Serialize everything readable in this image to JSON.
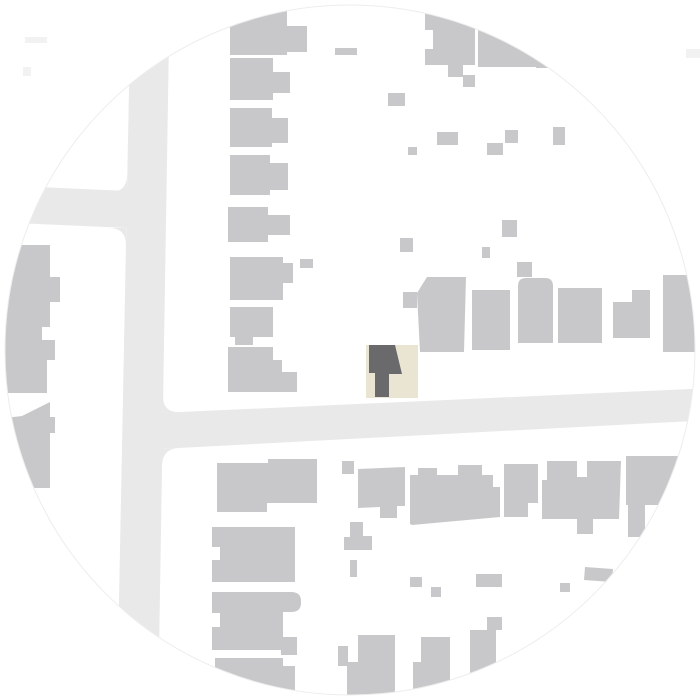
{
  "title": "Circular site location plan",
  "map": {
    "type": "site-plan",
    "canvas": {
      "width": 700,
      "height": 700
    },
    "background": "#ffffff",
    "circle": {
      "cx": 350,
      "cy": 350,
      "r": 345,
      "outline_color": "#ededee",
      "outline_width": 1
    },
    "colors": {
      "road": "#e9e9ea",
      "building": "#c8c8ca",
      "site_parcel": "#eae5d3",
      "site_building": "#6a6a6c",
      "faded_fragment": "#f2f2f2"
    },
    "roads": [
      {
        "name": "vertical-street",
        "path": "M130,38 L169,38 L159,652 L118,652 Z"
      },
      {
        "name": "west-side-street",
        "path": "M-8,185 L128,191 L128,228 L-8,222 Z"
      },
      {
        "name": "main-cross-street",
        "path": "M159,413 L712,388 L712,420 L159,449 Z"
      }
    ],
    "road_fillets": [
      "M127,175 L127,192 L110,192 Q127,192 127,175 Z",
      "M126,245 L126,228 L109,228 Q126,228 126,245 Z",
      "M163,396 L163,413 L180,412 Q163,413 163,396 Z",
      "M162,466 L162,449 L179,448 Q162,449 162,466 Z"
    ],
    "buildings": [
      "M230,0 L287,0 L287,26 L307,26 L307,52 L287,52 L287,55 L230,55 Z",
      "M230,58 L273,58 L273,72 L290,72 L290,93 L273,93 L273,100 L230,100 Z",
      "M230,108 L272,108 L272,118 L288,118 L288,143 L272,143 L272,147 L230,147 Z",
      "M230,155 L270,155 L270,163 L288,163 L288,190 L270,190 L270,195 L230,195 Z",
      "M228,207 L268,207 L268,215 L290,215 L290,235 L268,235 L268,242 L228,242 Z",
      "M230,257 L283,257 L283,263 L293,263 L293,283 L283,283 L283,300 L230,300 Z",
      "M300,259 L313,259 L313,268 L300,268 Z",
      "M230,307 L273,307 L273,337 L253,337 L253,345 L235,345 L235,337 L230,337 Z",
      "M228,347 L273,347 L273,360 L282,360 L282,372 L297,372 L297,392 L228,392 Z",
      "M-12,245 L50,245 L50,277 L60,277 L60,302 L50,302 L50,327 L42,327 L42,340 L55,340 L55,360 L47,360 L47,393 L-12,393 Z",
      "M-12,420 L22,416 L50,402 L50,417 L55,417 L55,433 L50,433 L50,488 L-12,488 Z",
      "M425,0 L475,0 L475,65 L463,65 L463,77 L448,77 L448,65 L425,65 L425,49 L433,49 L433,30 L425,30 Z",
      "M463,75 L475,75 L475,87 L463,87 Z",
      "M478,8 L543,8 L543,67 L478,67 Z",
      "M536,52 L560,52 L560,68 L536,68 Z",
      "M335,48 L357,48 L357,55 L335,55 Z",
      "M388,93 L405,93 L405,106 L388,106 Z",
      "M437,132 L458,132 L458,145 L437,145 Z",
      "M505,130 L518,130 L518,143 L505,143 Z",
      "M553,127 L565,127 L565,145 L553,145 Z",
      "M487,143 L503,143 L503,155 L487,155 Z",
      "M408,147 L417,147 L417,155 L408,155 Z",
      "M400,238 L413,238 L413,252 L400,252 Z",
      "M502,220 L517,220 L517,237 L502,237 Z",
      "M482,247 L490,247 L490,258 L482,258 Z",
      "M517,262 L532,262 L532,277 L517,277 Z",
      "M403,292 L417,292 L417,308 L403,308 Z",
      "M427,277 L466,277 L464,352 L420,352 L417,293 Z",
      "M472,290 L510,290 L510,350 L472,350 Z",
      "M518,286 Q518,278 526,278 L545,278 Q553,278 553,286 L553,343 L518,343 Z",
      "M558,288 L602,288 L602,343 L558,343 Z",
      "M613,302 L650,302 L650,338 L613,338 Z",
      "M632,290 L650,290 L650,302 L632,302 Z",
      "M663,275 L705,275 L705,352 L663,352 Z",
      "M217,463 L268,463 L268,459 L317,459 L317,503 L267,503 L267,512 L217,512 Z",
      "M212,527 L295,527 L295,582 L212,582 L212,560 L220,560 L220,547 L212,547 Z",
      "M212,592 L291,592 Q301,592 301,601 L301,603 Q301,612 291,612 L283,612 L283,637 L297,637 L297,655 L281,655 L281,650 L212,650 L212,627 L220,627 L220,613 L212,613 Z",
      "M215,658 L283,658 L283,666 L295,666 L295,702 L215,702 Z",
      "M342,461 L354,461 L354,474 L342,474 Z",
      "M358,469 L405,467 L405,506 L397,506 L397,518 L380,518 L380,507 L358,508 Z",
      "M410,475 L418,475 L418,468 L437,468 L437,475 L458,475 L458,465 L482,465 L482,475 L493,475 L493,487 L500,487 L500,517 L412,525 L410,524 Z",
      "M504,464 L538,464 L538,503 L528,503 L528,517 L504,517 Z",
      "M547,461 L577,461 L577,477 L587,477 L587,461 L621,461 L619,519 L593,519 L593,534 L577,534 L577,519 L542,519 L542,480 L547,480 Z",
      "M626,456 L702,456 L702,505 L645,505 L645,537 L628,537 L628,505 L626,505 Z",
      "M350,522 L363,522 L363,536 L372,536 L372,550 L344,550 L344,537 L350,537 Z",
      "M350,560 L357,560 L357,577 L350,577 Z",
      "M410,577 L422,577 L422,587 L410,587 Z",
      "M431,587 L441,587 L441,597 L431,597 Z",
      "M476,574 L502,574 L502,587 L476,587 Z",
      "M487,617 L502,617 L502,630 L487,630 Z",
      "M560,583 L570,583 L570,592 L560,592 Z",
      "M585,567 L613,569 L612,582 L584,580 Z",
      "M338,646 L348,646 L348,666 L338,666 Z",
      "M358,635 L395,635 L395,700 L347,700 L347,662 L358,662 Z",
      "M421,637 L450,637 L450,700 L413,700 L413,662 L421,662 Z",
      "M470,630 L496,630 L496,700 L470,700 Z"
    ],
    "faded_fragments": [
      "M25,37 L47,37 L47,43 L25,43 Z",
      "M23,67 L31,67 L31,76 L23,76 Z",
      "M686,49 L701,49 L701,58 L686,58 Z"
    ],
    "site": {
      "parcel_path": "M366,345 L418,345 L418,398 L366,398 Z",
      "building_path": "M369,345 L395,345 L402,374 L389,374 L389,397 L375,397 L375,373 L369,373 Z"
    }
  }
}
